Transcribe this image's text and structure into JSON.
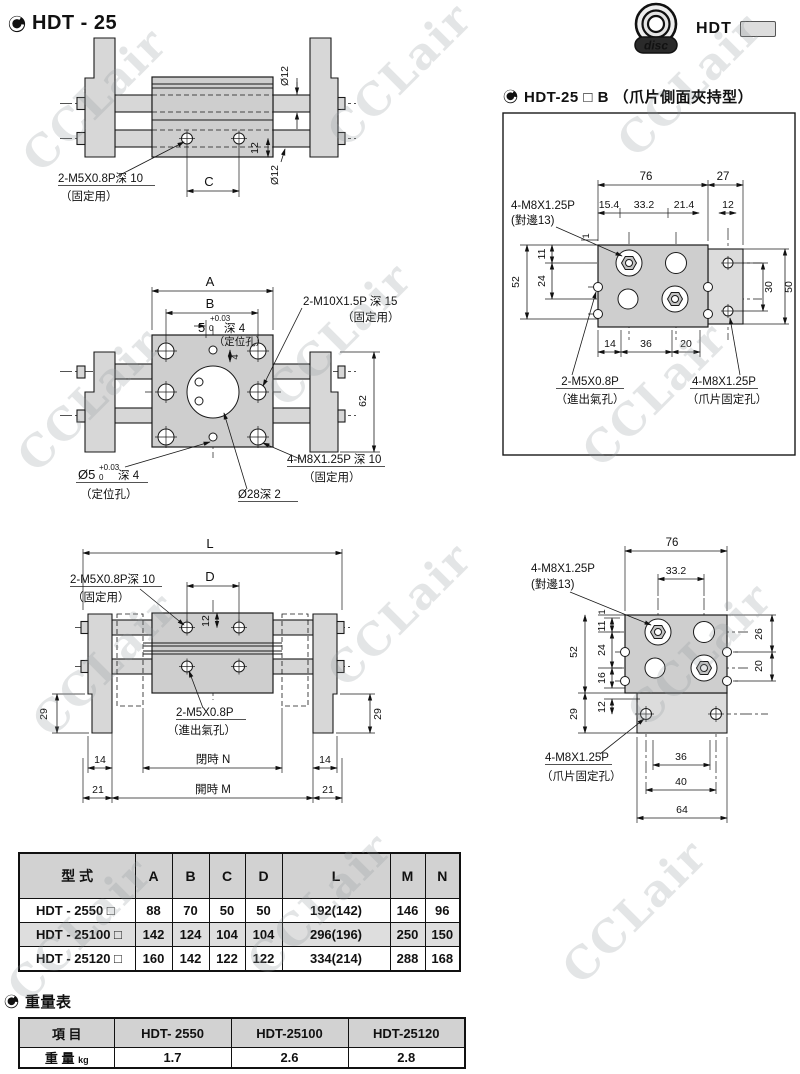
{
  "watermark": "CCLair",
  "page_title": "HDT - 25",
  "logo": {
    "brand": "HDT",
    "badge": "disc"
  },
  "section_b_title": "HDT-25 □ B （爪片側面夾持型）",
  "weight_section_title": "重量表",
  "drawings": {
    "side_view": {
      "dia12_top": "Ø12",
      "dim12": "12",
      "dia12_bottom": "Ø12",
      "dim_c": "C",
      "tap_label": "2-M5X0.8P深 10",
      "tap_note": "（固定用）"
    },
    "front_view": {
      "dim_a": "A",
      "dim_b": "B",
      "pin5": "5",
      "pin5_tol_up": "+0.03",
      "pin5_tol_dn": "0",
      "pin5_depth": "深 4",
      "pin5_note": "（定位孔）",
      "m10_label": "2-M10X1.5P 深 15",
      "m10_note": "（固定用）",
      "dim4": "4",
      "dim62": "62",
      "m8_label": "4-M8X1.25P 深 10",
      "m8_note": "（固定用）",
      "pin5b": "Ø5",
      "pin5b_tol_up": "+0.03",
      "pin5b_tol_dn": "0",
      "pin5b_depth": "深 4",
      "pin5b_note": "（定位孔）",
      "dia28": "Ø28深 2"
    },
    "stroke_view": {
      "dim_l": "L",
      "dim_d": "D",
      "tap_label": "2-M5X0.8P深 10",
      "tap_note": "（固定用）",
      "dim12": "12",
      "port_label": "2-M5X0.8P",
      "port_note": "（進出氣孔）",
      "dim29_left": "29",
      "dim29_right": "29",
      "dim14_left": "14",
      "dim14_right": "14",
      "closed_n": "閉時 N",
      "dim21_left": "21",
      "dim21_right": "21",
      "open_m": "開時 M"
    },
    "side_grip_view": {
      "dim76": "76",
      "dim27": "27",
      "dim154": "15.4",
      "dim332": "33.2",
      "dim214": "21.4",
      "dim12": "12",
      "m8_label": "4-M8X1.25P",
      "m8_note": "(對邊13)",
      "dim1": "1",
      "dim11": "11",
      "dim24": "24",
      "dim52": "52",
      "dim30": "30",
      "dim50": "50",
      "dim14": "14",
      "dim36": "36",
      "dim20": "20",
      "port_label": "2-M5X0.8P",
      "port_note": "（進出氣孔）",
      "claw_label": "4-M8X1.25P",
      "claw_note": "（爪片固定孔）"
    },
    "claw_view": {
      "dim76": "76",
      "dim332": "33.2",
      "m8_label": "4-M8X1.25P",
      "m8_note": "(對邊13)",
      "dim1": "1",
      "dim11": "11",
      "dim24": "24",
      "dim16": "16",
      "dim52": "52",
      "dim29": "29",
      "dim12": "12",
      "dim26": "26",
      "dim20": "20",
      "dim36": "36",
      "dim40": "40",
      "dim64": "64",
      "claw_label": "4-M8X1.25P",
      "claw_note": "（爪片固定孔）"
    }
  },
  "dim_table": {
    "headers": [
      "型 式",
      "A",
      "B",
      "C",
      "D",
      "L",
      "M",
      "N"
    ],
    "rows": [
      {
        "model": "HDT - 2550  □",
        "a": "88",
        "b": "70",
        "c": "50",
        "d": "50",
        "l": "192(142)",
        "m": "146",
        "n": "96"
      },
      {
        "model": "HDT - 25100 □",
        "a": "142",
        "b": "124",
        "c": "104",
        "d": "104",
        "l": "296(196)",
        "m": "250",
        "n": "150"
      },
      {
        "model": "HDT - 25120 □",
        "a": "160",
        "b": "142",
        "c": "122",
        "d": "122",
        "l": "334(214)",
        "m": "288",
        "n": "168"
      }
    ]
  },
  "weight_table": {
    "item_header": "項 目",
    "col_headers": [
      "HDT- 2550",
      "HDT-25100",
      "HDT-25120"
    ],
    "row_label": "重 量",
    "row_unit": "kg",
    "values": [
      "1.7",
      "2.6",
      "2.8"
    ]
  }
}
